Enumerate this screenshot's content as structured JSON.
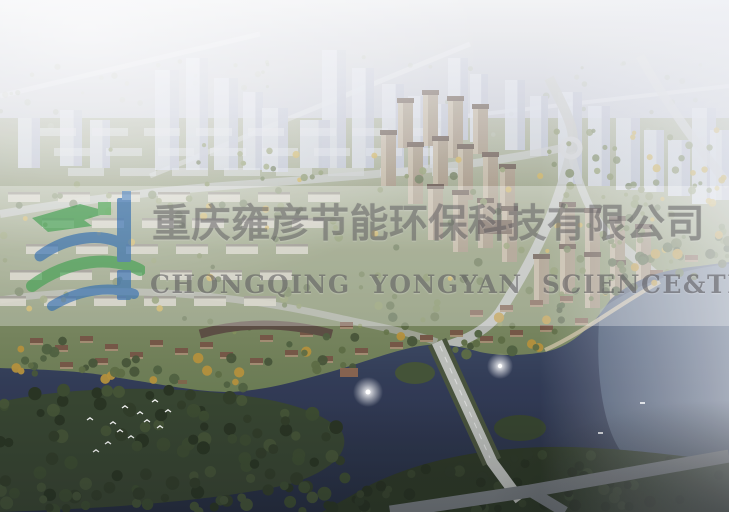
{
  "image": {
    "type": "aerial-architectural-rendering",
    "subject": "lakeside residential development masterplan"
  },
  "watermark": {
    "logo_icon": "yongyan-logo",
    "company_name_cn": "重庆雍彦节能环保科技有限公司",
    "company_name_en": "CHONGQING YONGYAN SCIENCE&TECHNOLOGY",
    "colors": {
      "logo_green": "#3da04e",
      "logo_green_light": "#55b15f",
      "logo_blue": "#2d6bb2",
      "logo_blue_light": "#5b8fc9",
      "text_gray": "#5e5c60"
    }
  },
  "scene_colors": {
    "sky_haze": "#c6c8d2",
    "ghost_tower": "#cdd2df",
    "ghost_tower_shade": "#a6adc0",
    "land_green": "#7e8a64",
    "autumn_tree": "#c0a03e",
    "forest_dark": "#26331e",
    "lake_dark": "#222d44",
    "lake_light_right": "#8fa6ba",
    "building_tan": "#93836d",
    "roof_brown": "#4a382d",
    "road_gray": "#b7bab9",
    "fountain_white": "#ffffff",
    "bird_white": "#ffffff"
  }
}
